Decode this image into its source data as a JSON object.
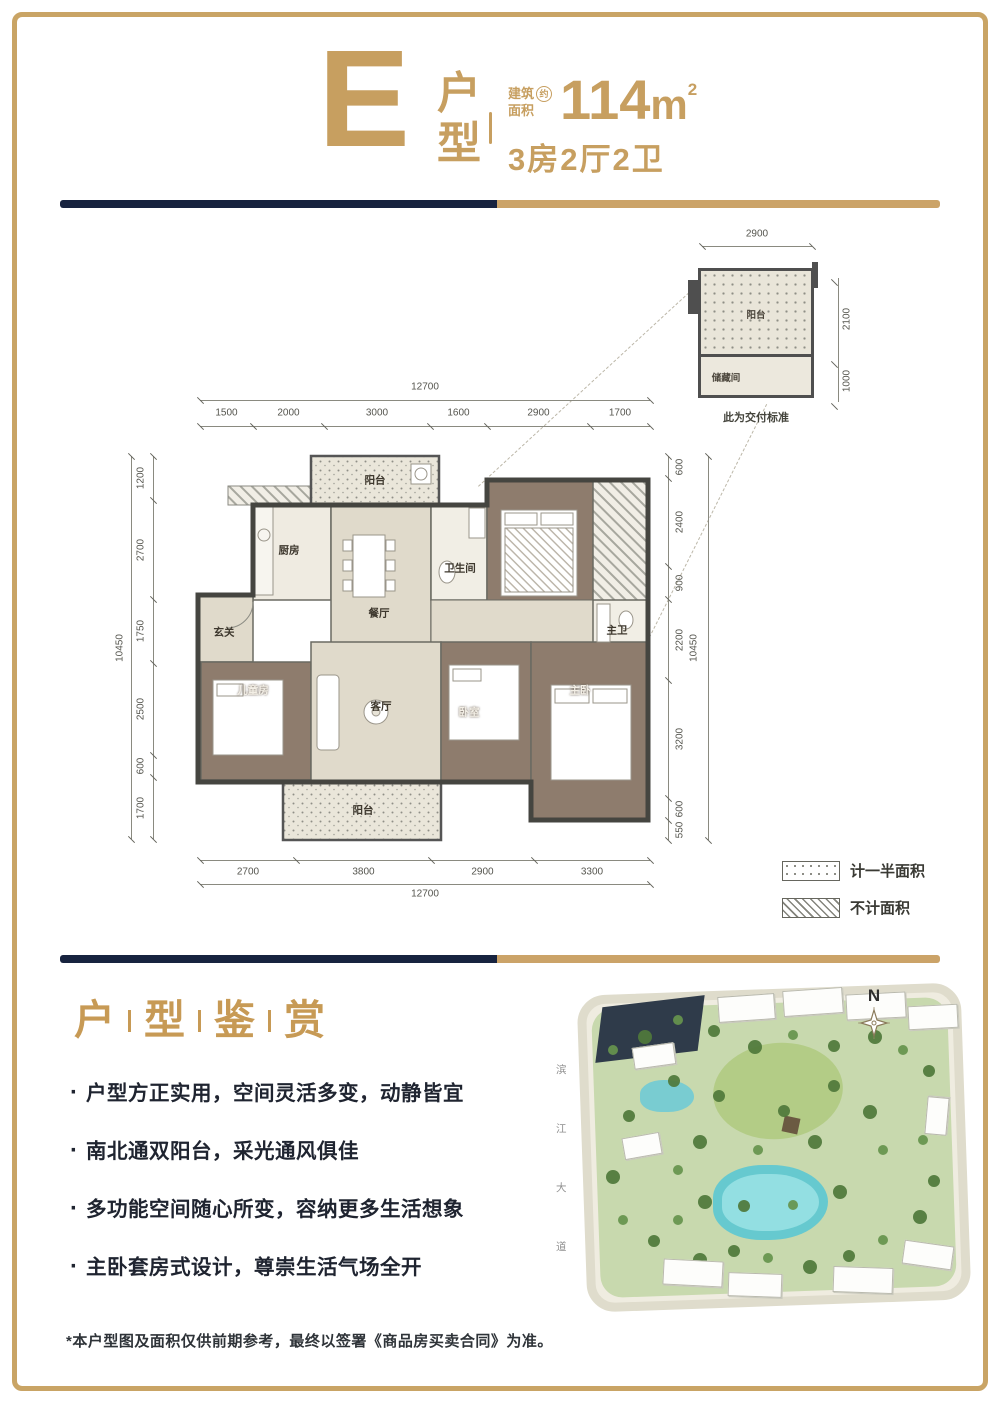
{
  "page": {
    "frame_color": "#C9A465"
  },
  "header": {
    "unit_letter": "E",
    "unit_label_chars": [
      "户",
      "型"
    ],
    "area_prefix_top": "建筑",
    "area_prefix_bottom": "面积",
    "area_circled": "约",
    "area_value": "114",
    "area_unit": "m",
    "area_exponent": "2",
    "layout_text": "3房2厅2卫"
  },
  "floor_plan": {
    "dims": {
      "top": {
        "total": "12700",
        "segments": [
          "1500",
          "2000",
          "3000",
          "1600",
          "2900",
          "1700"
        ]
      },
      "bottom": {
        "total": "12700",
        "segments": [
          "2700",
          "3800",
          "2900",
          "3300"
        ]
      },
      "left": {
        "total": "10450",
        "segments": [
          "1200",
          "2700",
          "1750",
          "2500",
          "600",
          "1700"
        ]
      },
      "right": {
        "total": "10450",
        "segments": [
          "600",
          "2400",
          "900",
          "2200",
          "3200",
          "600",
          "550"
        ]
      }
    },
    "rooms": [
      {
        "name": "north-balcony",
        "label": "阳台"
      },
      {
        "name": "kitchen",
        "label": "厨房"
      },
      {
        "name": "dining-room",
        "label": "餐厅"
      },
      {
        "name": "bathroom",
        "label": "卫生间"
      },
      {
        "name": "foyer",
        "label": "玄关"
      },
      {
        "name": "kids-room",
        "label": "儿童房"
      },
      {
        "name": "living-room",
        "label": "客厅"
      },
      {
        "name": "bedroom",
        "label": "卧室"
      },
      {
        "name": "master-bedroom",
        "label": "主卧"
      },
      {
        "name": "master-bathroom",
        "label": "主卫"
      },
      {
        "name": "south-balcony",
        "label": "阳台"
      }
    ]
  },
  "detail_diagram": {
    "dims": {
      "width": "2900",
      "balcony_depth": "2100",
      "storage_depth": "1000"
    },
    "balcony_label": "阳台",
    "storage_label": "储藏间",
    "caption": "此为交付标准"
  },
  "legend": {
    "items": [
      {
        "label": "计一半面积"
      },
      {
        "label": "不计面积"
      }
    ]
  },
  "appreciation": {
    "title_chars": [
      "户",
      "型",
      "鉴",
      "赏"
    ],
    "bullets": [
      "户型方正实用，空间灵活多变，动静皆宜",
      "南北通双阳台，采光通风俱佳",
      "多功能空间随心所变，容纳更多生活想象",
      "主卧套房式设计，尊崇生活气场全开"
    ]
  },
  "site_plan": {
    "north_label": "N",
    "road_chars": [
      "滨",
      "江",
      "大",
      "道"
    ]
  },
  "disclaimer": "*本户型图及面积仅供前期参考，最终以签署《商品房买卖合同》为准。"
}
